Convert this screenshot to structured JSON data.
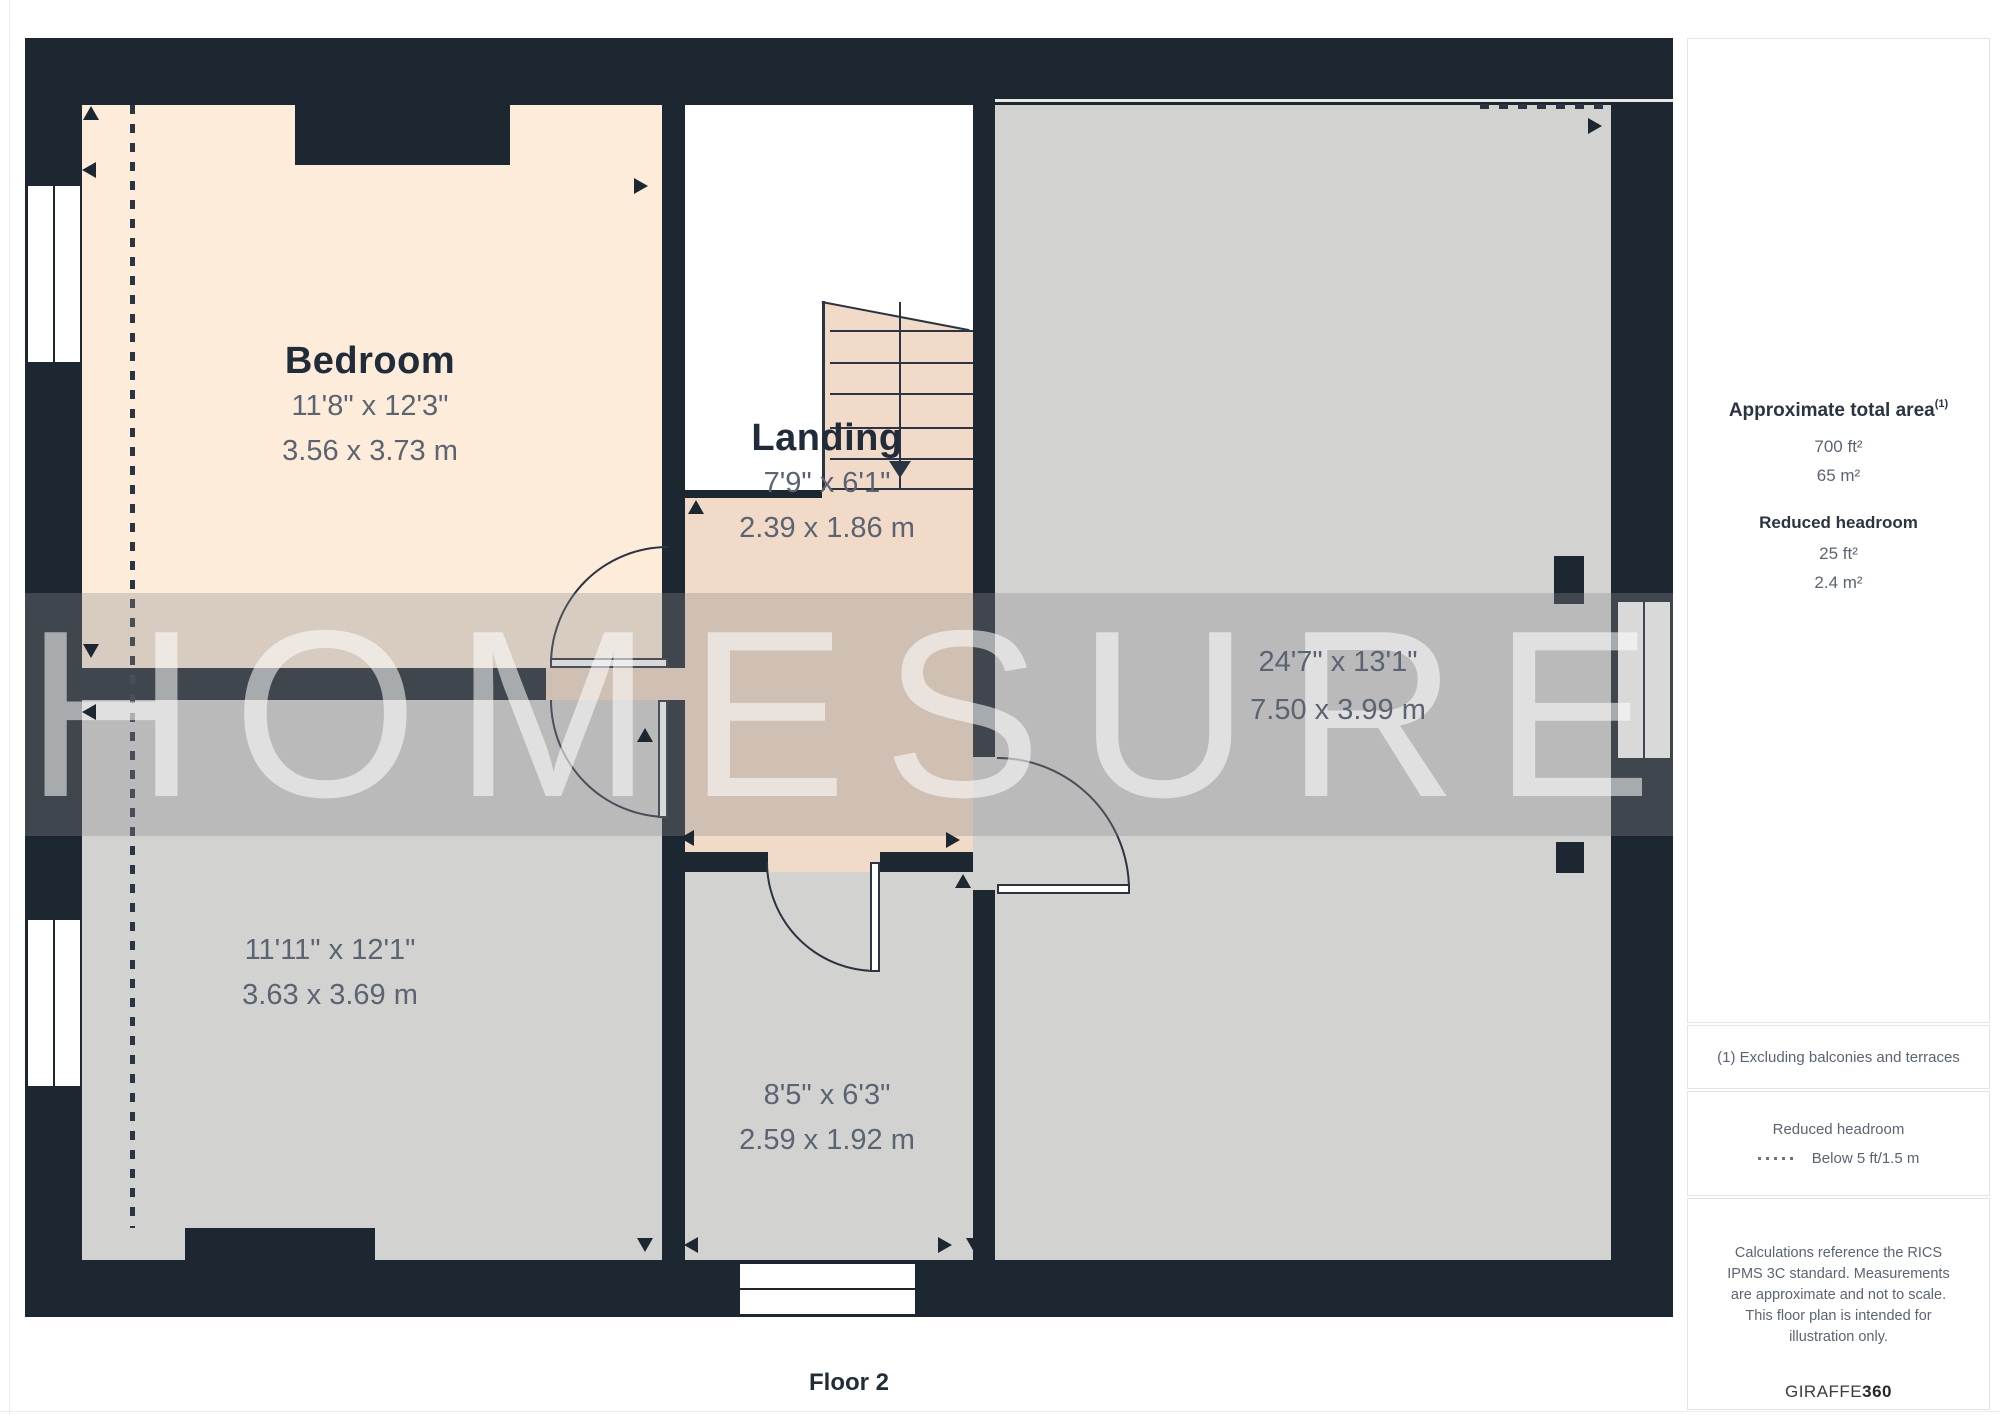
{
  "plan": {
    "floor_label": "Floor 2",
    "watermark": "HOMESURE",
    "rooms": [
      {
        "id": "bedroom",
        "name": "Bedroom",
        "dims_ft": "11'8\" x 12'3\"",
        "dims_m": "3.56 x 3.73 m"
      },
      {
        "id": "landing",
        "name": "Landing",
        "dims_ft": "7'9\" x 6'1\"",
        "dims_m": "2.39 x 1.86 m"
      },
      {
        "id": "room-right",
        "name": "",
        "dims_ft": "24'7\" x 13'1\"",
        "dims_m": "7.50 x 3.99 m"
      },
      {
        "id": "room-bottom-left",
        "name": "",
        "dims_ft": "11'11\" x 12'1\"",
        "dims_m": "3.63 x 3.69 m"
      },
      {
        "id": "room-bottom-center",
        "name": "",
        "dims_ft": "8'5\" x 6'3\"",
        "dims_m": "2.59 x 1.92 m"
      }
    ],
    "colors": {
      "wall": "#1c2732",
      "bedroom_fill": "#fcecd9",
      "room_fill": "#d2d2d1",
      "landing_fill": "#f2dac8"
    }
  },
  "sidebar": {
    "total_area": {
      "label": "Approximate total area",
      "superscript": "(1)",
      "value_ft": "700 ft²",
      "value_m": "65 m²"
    },
    "reduced_headroom": {
      "label": "Reduced headroom",
      "value_ft": "25 ft²",
      "value_m": "2.4 m²"
    },
    "footnote": "(1) Excluding balconies and terraces",
    "legend": {
      "title": "Reduced headroom",
      "entry": "Below 5 ft/1.5 m"
    },
    "disclaimer": "Calculations reference the RICS IPMS 3C standard. Measurements are approximate and not to scale. This floor plan is intended for illustration only.",
    "brand": {
      "name": "GIRAFFE",
      "suffix": "360"
    }
  }
}
